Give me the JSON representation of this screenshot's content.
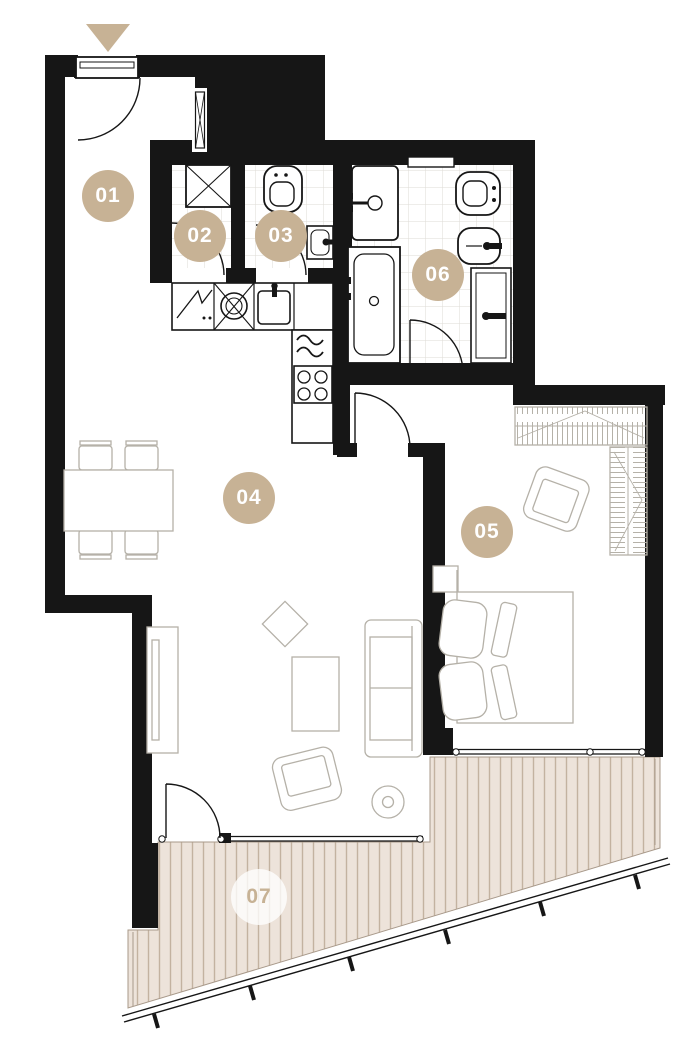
{
  "plan": {
    "rooms": [
      {
        "label": "01"
      },
      {
        "label": "02"
      },
      {
        "label": "03"
      },
      {
        "label": "04"
      },
      {
        "label": "05"
      },
      {
        "label": "06"
      },
      {
        "label": "07"
      }
    ],
    "icons": {
      "entrance_marker": "▼"
    },
    "colors": {
      "accent": "#c7b295",
      "wall": "#161616",
      "deck_fill": "#ede3da",
      "deck_stripe": "#c3b2a0",
      "furniture_line": "#b5b1a8",
      "tile_line": "#dedbd5",
      "terrace_label_bg": "rgba(255,255,255,0.78)"
    }
  }
}
